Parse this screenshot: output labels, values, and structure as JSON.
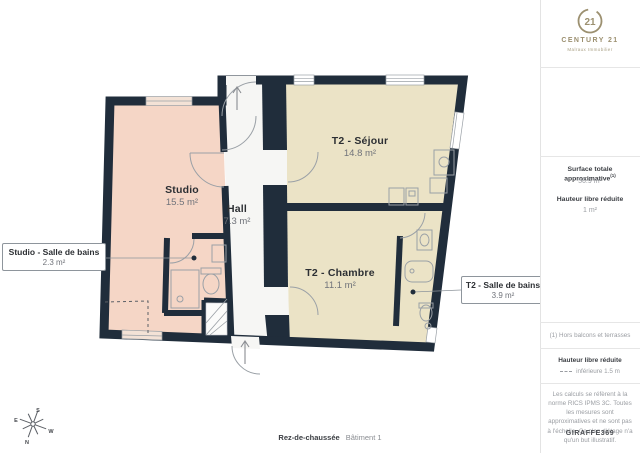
{
  "brand": {
    "name": "CENTURY 21",
    "tagline": "Malraux Immobilier",
    "seal_number": "21",
    "gold": "#9c9070"
  },
  "sidebar": {
    "surface_label": "Surface totale approximative",
    "surface_sup": "(1)",
    "surface_value": "56.9 m²",
    "reduced_label": "Hauteur libre réduite",
    "reduced_value": "1 m²",
    "footnote": "(1) Hors balcons et terrasses",
    "legend_title": "Hauteur libre réduite",
    "legend_value": "inférieure 1.5 m",
    "disclaimer": "Les calculs se réfèrent à la norme RICS IPMS 3C. Toutes les mesures sont approximatives et ne sont pas à l'échelle. Ce plan d'étage n'a qu'un but illustratif.",
    "reference": "GIRAFFE369"
  },
  "plan": {
    "rooms": [
      {
        "name": "T2 - Séjour",
        "area": "14.8 m²"
      },
      {
        "name": "Studio",
        "area": "15.5 m²"
      },
      {
        "name": "Hall",
        "area": "7.3 m²"
      },
      {
        "name": "T2 - Chambre",
        "area": "11.1 m²"
      }
    ],
    "callouts": [
      {
        "name": "Studio - Salle de bains",
        "area": "2.3 m²"
      },
      {
        "name": "T2 - Salle de bains",
        "area": "3.9 m²"
      }
    ],
    "caption": {
      "floor": "Rez-de-chaussée",
      "building": "Bâtiment 1"
    },
    "compass": {
      "n": "N",
      "s": "S",
      "e": "E",
      "w": "W"
    },
    "colors": {
      "wall": "#202d3b",
      "studio_fill": "#f5d6c6",
      "t2_fill": "#ebe3c6",
      "hall_fill": "#f6f6f4"
    }
  }
}
